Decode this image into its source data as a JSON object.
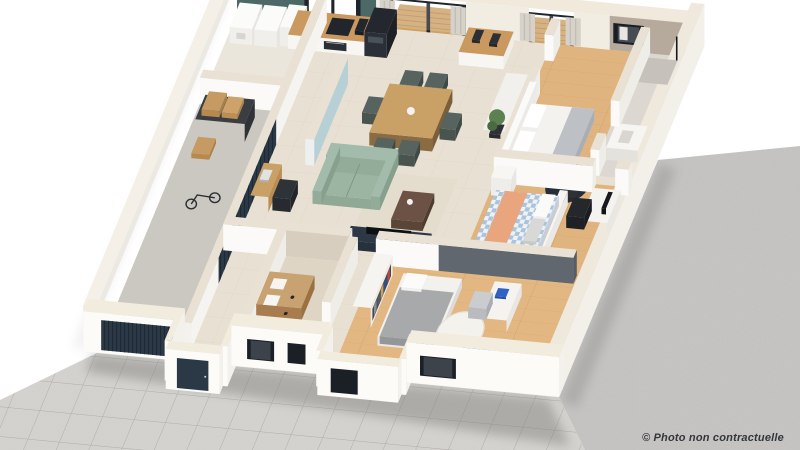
{
  "watermark": "© Photo non contractuelle",
  "scene": {
    "type": "3d-floor-plan-render",
    "view": "isometric dollhouse cutaway of a single-storey house on paved and gravel ground",
    "rooms": [
      "garage",
      "laundry-room",
      "kitchen",
      "dining-area",
      "living-room",
      "entry-hall",
      "hallway",
      "bathroom",
      "walk-in-closet",
      "master-bedroom",
      "ensuite-shower-room",
      "bedroom-2",
      "bedroom-3",
      "wood-deck-terrace",
      "front-porch"
    ],
    "exterior": [
      "paved-driveway",
      "gravel-yard",
      "white-backdrop"
    ],
    "palette": {
      "teal": "#4d6967",
      "blue_wall": "#b7d0d6",
      "navy": "#2b3947",
      "navy_dark": "#1f2935",
      "sage": "#9cb5a3",
      "wood_floor": "#e0b47f",
      "wood_counter": "#c9995f",
      "travertine": "#e8e1d3",
      "concrete": "#cbc8c2",
      "gravel": "#c8c7c5",
      "pavers": "#d7d5d1",
      "wall_white": "#fbfaf8",
      "wall_top": "#e9e2d4",
      "stone_face": "#d8cec0",
      "taupe": "#b6aa9c",
      "gingham": "#a9c4dc",
      "peach": "#e8a57e",
      "deck_wood": "#cda268",
      "gray_wall": "#60676f",
      "watermark_color": "#33363b"
    }
  }
}
